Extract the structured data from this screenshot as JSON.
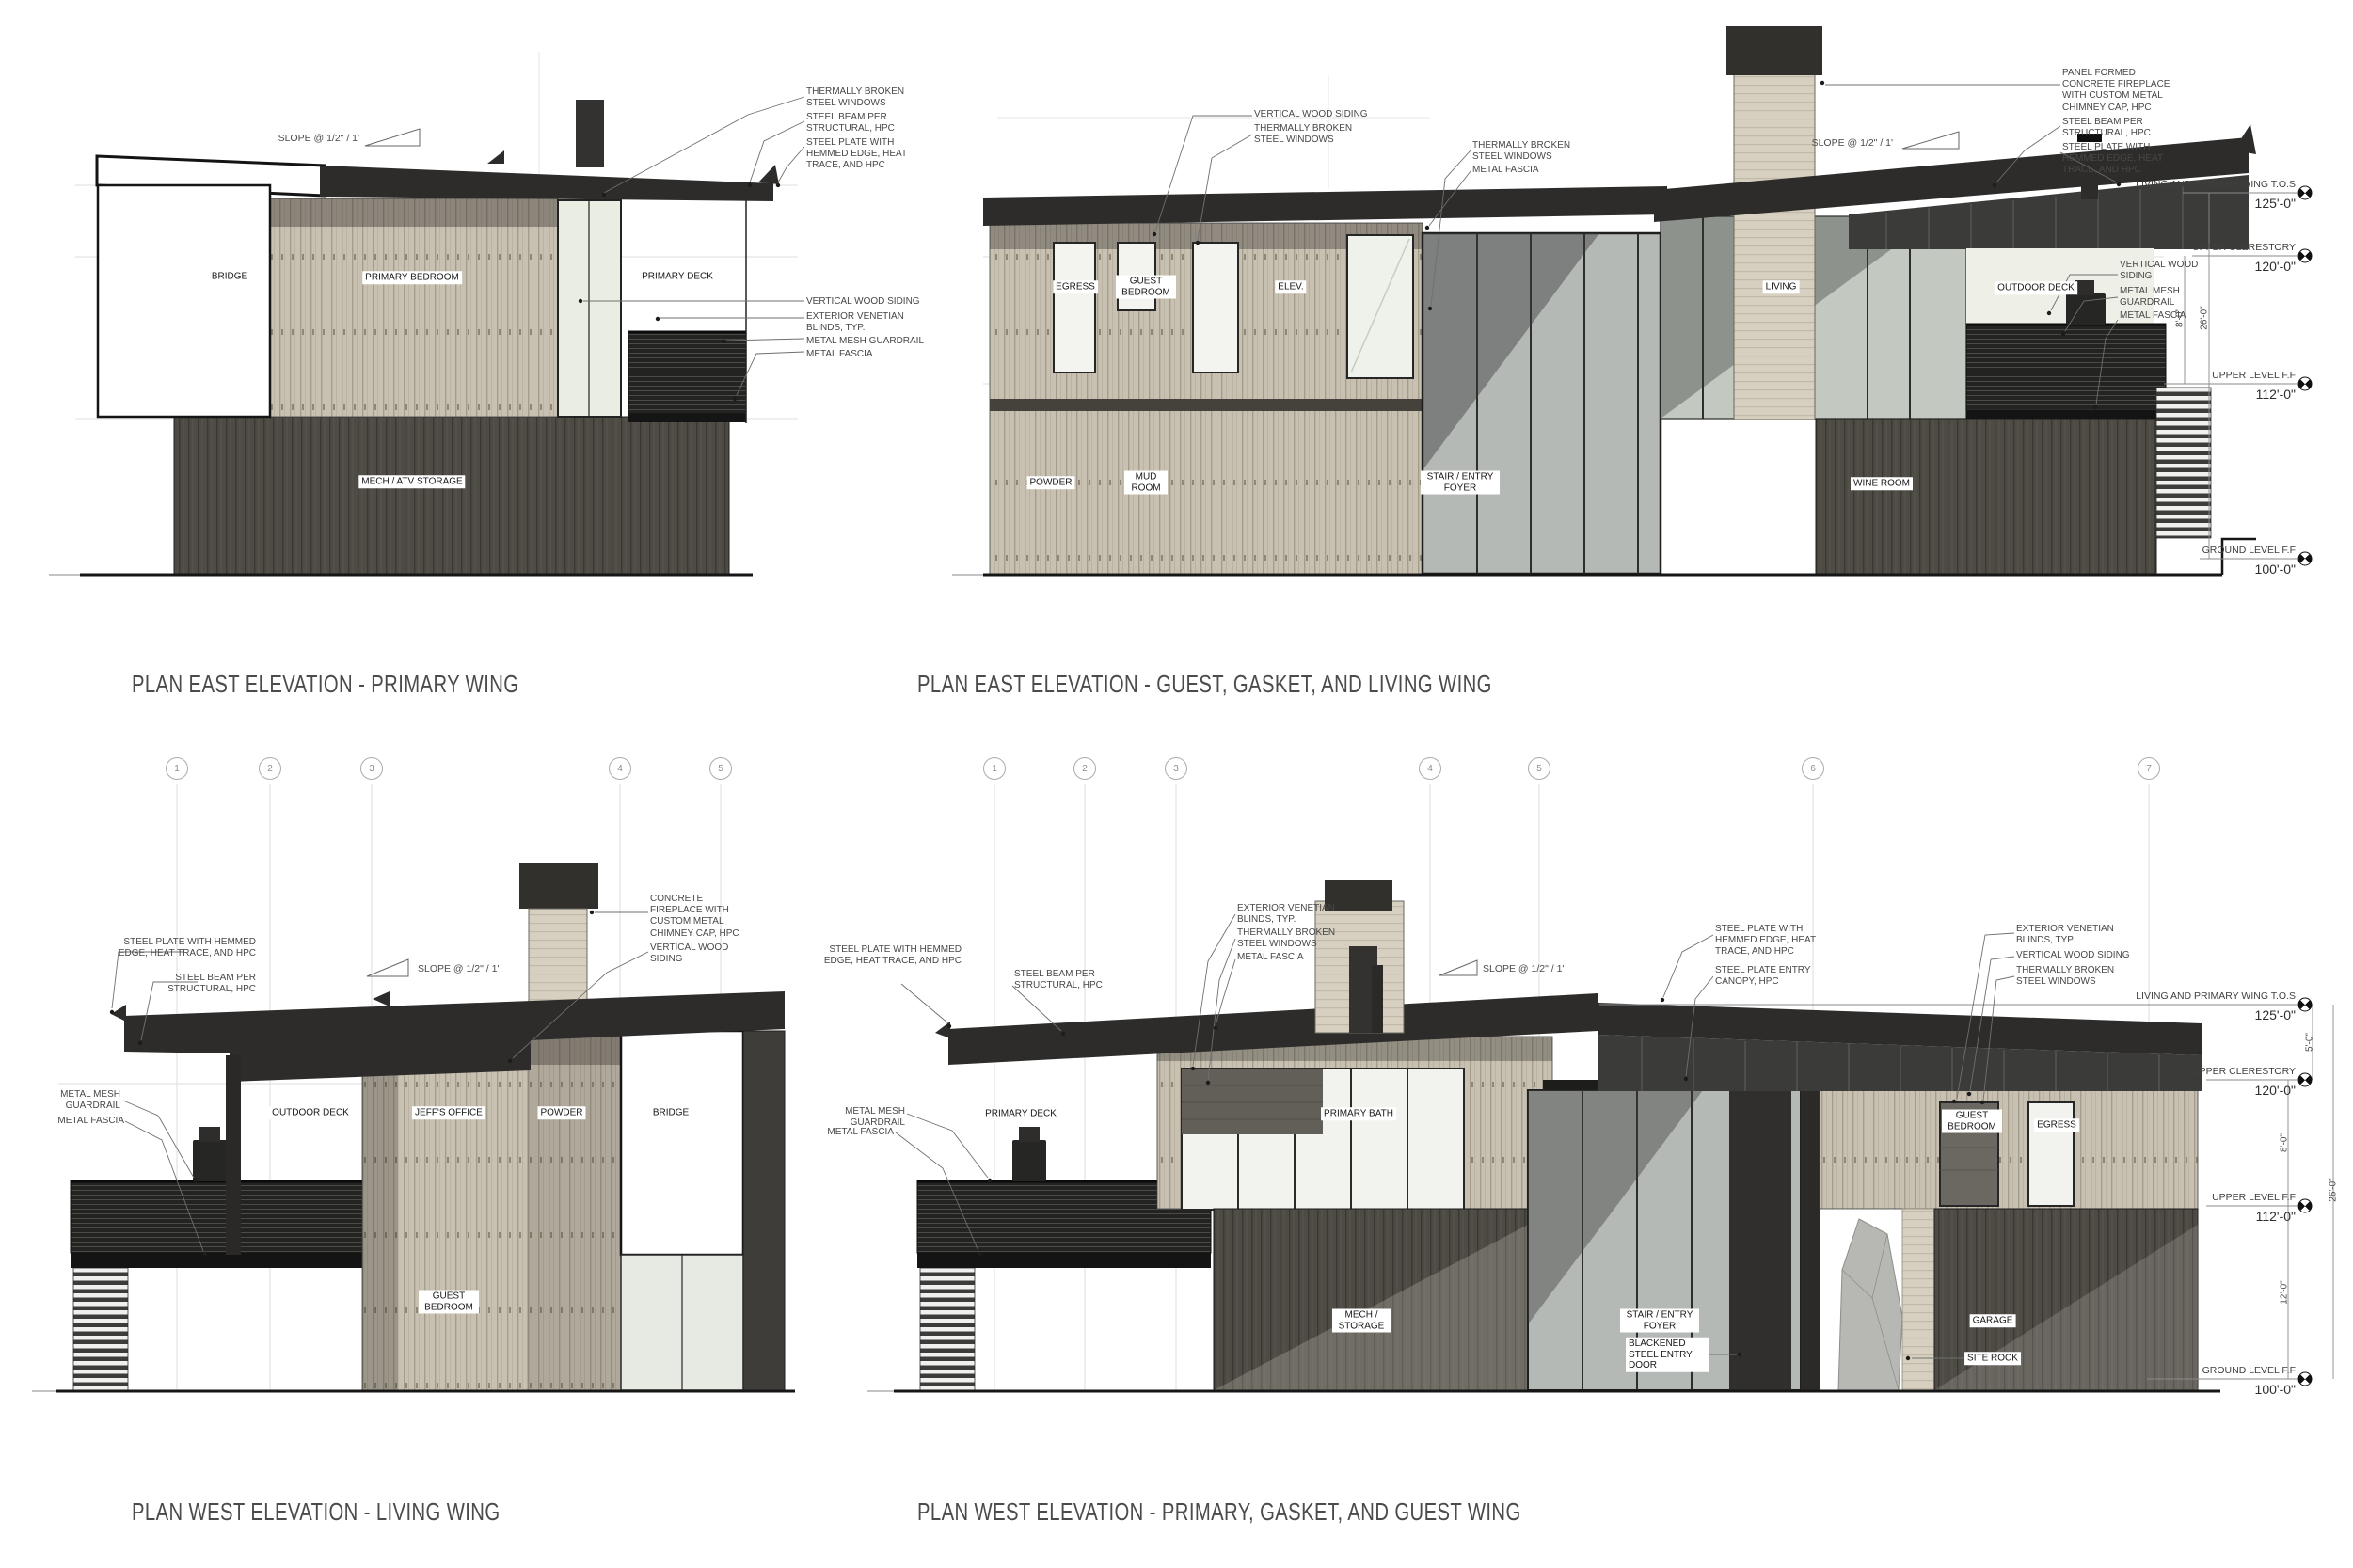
{
  "titles": {
    "tl": "PLAN EAST ELEVATION - PRIMARY WING",
    "tr": "PLAN EAST ELEVATION - GUEST, GASKET, AND LIVING WING",
    "bl": "PLAN WEST ELEVATION - LIVING WING",
    "br": "PLAN WEST ELEVATION - PRIMARY, GASKET, AND GUEST WING"
  },
  "slope": "SLOPE @ 1/2\" / 1'",
  "tl": {
    "rooms": {
      "bridge": "BRIDGE",
      "bedroom": "PRIMARY BEDROOM",
      "deck": "PRIMARY DECK",
      "mech": "MECH / ATV STORAGE"
    },
    "callouts": {
      "windows": "THERMALLY BROKEN STEEL WINDOWS",
      "beam": "STEEL BEAM PER STRUCTURAL, HPC",
      "plate": "STEEL PLATE WITH HEMMED EDGE, HEAT TRACE, AND HPC",
      "siding": "VERTICAL WOOD SIDING",
      "blinds": "EXTERIOR VENETIAN BLINDS, TYP.",
      "mesh": "METAL MESH GUARDRAIL",
      "fascia": "METAL FASCIA"
    }
  },
  "tr": {
    "rooms": {
      "egress": "EGRESS",
      "guest": "GUEST BEDROOM",
      "elev": "ELEV.",
      "powder": "POWDER",
      "mud": "MUD ROOM",
      "stair": "STAIR / ENTRY FOYER",
      "living": "LIVING",
      "deck": "OUTDOOR DECK",
      "wine": "WINE ROOM"
    },
    "callouts": {
      "siding": "VERTICAL WOOD SIDING",
      "windows1": "THERMALLY BROKEN STEEL WINDOWS",
      "windows2": "THERMALLY BROKEN STEEL WINDOWS",
      "fascia1": "METAL FASCIA",
      "chimney": "PANEL FORMED CONCRETE FIREPLACE WITH CUSTOM METAL CHIMNEY CAP, HPC",
      "beam": "STEEL BEAM PER STRUCTURAL, HPC",
      "plate": "STEEL PLATE WITH HEMMED EDGE, HEAT TRACE, AND HPC",
      "siding2": "VERTICAL WOOD SIDING",
      "mesh": "METAL MESH GUARDRAIL",
      "fascia2": "METAL FASCIA"
    },
    "levels": [
      {
        "name": "LIVING AND PRIMARY WING T.O.S",
        "elev": "125'-0\""
      },
      {
        "name": "UPPER CLERESTORY",
        "elev": "120'-0\""
      },
      {
        "name": "UPPER LEVEL F.F",
        "elev": "112'-0\""
      },
      {
        "name": "GROUND LEVEL F.F",
        "elev": "100'-0\""
      }
    ],
    "dims": [
      "8'-0\"",
      "26'-0\""
    ]
  },
  "bl": {
    "bubbles": [
      "1",
      "2",
      "3",
      "4",
      "5"
    ],
    "rooms": {
      "deck": "OUTDOOR DECK",
      "office": "JEFF'S OFFICE",
      "powder": "POWDER",
      "bridge": "BRIDGE",
      "guest": "GUEST BEDROOM"
    },
    "callouts": {
      "plate": "STEEL PLATE WITH HEMMED EDGE, HEAT TRACE, AND HPC",
      "beam": "STEEL BEAM PER STRUCTURAL, HPC",
      "mesh": "METAL MESH GUARDRAIL",
      "fascia": "METAL FASCIA",
      "chimney": "CONCRETE FIREPLACE WITH CUSTOM METAL CHIMNEY CAP, HPC",
      "siding": "VERTICAL WOOD SIDING"
    }
  },
  "br": {
    "bubbles": [
      "1",
      "2",
      "3",
      "4",
      "5",
      "6",
      "7"
    ],
    "rooms": {
      "deck": "PRIMARY DECK",
      "bath": "PRIMARY BATH",
      "mech": "MECH / STORAGE",
      "stair": "STAIR / ENTRY FOYER",
      "guest": "GUEST BEDROOM",
      "egress": "EGRESS",
      "garage": "GARAGE",
      "rock": "SITE ROCK"
    },
    "callouts": {
      "plate1": "STEEL PLATE WITH HEMMED EDGE, HEAT TRACE, AND HPC",
      "beam": "STEEL BEAM PER STRUCTURAL, HPC",
      "mesh": "METAL MESH GUARDRAIL",
      "fascia1": "METAL FASCIA",
      "blinds1": "EXTERIOR VENETIAN BLINDS, TYP.",
      "windows1": "THERMALLY BROKEN STEEL WINDOWS",
      "fascia2": "METAL FASCIA",
      "plate2": "STEEL PLATE WITH HEMMED EDGE, HEAT TRACE, AND HPC",
      "canopy": "STEEL PLATE ENTRY CANOPY, HPC",
      "blinds2": "EXTERIOR VENETIAN BLINDS, TYP.",
      "siding": "VERTICAL WOOD SIDING",
      "windows2": "THERMALLY BROKEN STEEL WINDOWS",
      "door": "BLACKENED STEEL ENTRY DOOR"
    },
    "levels": [
      {
        "name": "LIVING AND PRIMARY WING T.O.S",
        "elev": "125'-0\""
      },
      {
        "name": "UPPER CLERESTORY",
        "elev": "120'-0\""
      },
      {
        "name": "UPPER LEVEL F.F",
        "elev": "112'-0\""
      },
      {
        "name": "GROUND LEVEL F.F",
        "elev": "100'-0\""
      }
    ],
    "dims": [
      "5'-0\"",
      "8'-0\"",
      "26'-0\"",
      "12'-0\""
    ]
  }
}
